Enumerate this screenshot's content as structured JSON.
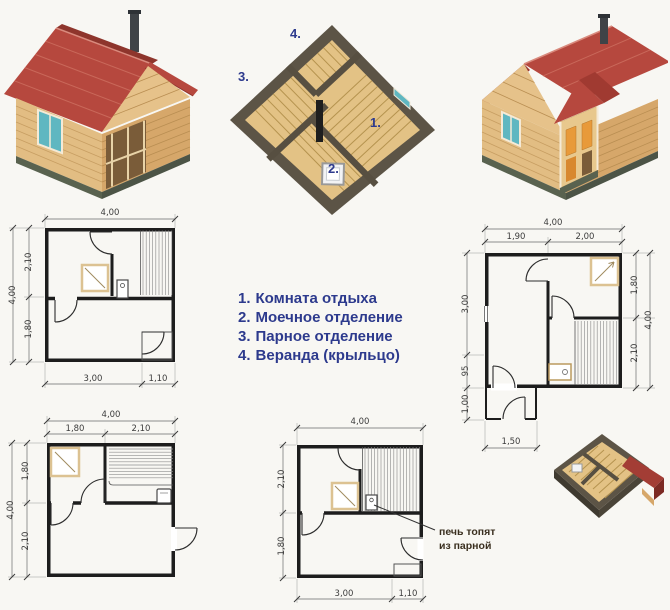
{
  "legend": {
    "items": [
      {
        "num": "1.",
        "label": "Комната отдыха"
      },
      {
        "num": "2.",
        "label": "Моечное отделение"
      },
      {
        "num": "3.",
        "label": "Парное отделение"
      },
      {
        "num": "4.",
        "label": "Веранда (крыльцо)"
      }
    ]
  },
  "cutaway": {
    "label_rest": "1.",
    "label_wash": "2.",
    "label_steam": "3.",
    "label_veranda": "4."
  },
  "annotation": {
    "line1": "печь топят",
    "line2": "из парной"
  },
  "plans": {
    "a": {
      "top": "4,00",
      "left_outer": "4,00",
      "left_top": "2,10",
      "left_bottom": "1,80",
      "bottom_main": "3,00",
      "bottom_porch": "1,10"
    },
    "b": {
      "top": "4,00",
      "top_left": "1,90",
      "top_right": "2,00",
      "left_top": "3,00",
      "left_mid": "95",
      "left_bottom": "1,00",
      "right_top": "1,80",
      "right_bottom": "2,10",
      "right_outer": "4,00",
      "bottom": "1,50"
    },
    "c": {
      "top": "4,00",
      "top_left": "1,80",
      "top_right": "2,10",
      "left_top": "1,80",
      "left_bottom": "2,10",
      "left_outer": "4,00"
    },
    "d": {
      "top": "4,00",
      "left_top": "2,10",
      "left_bottom": "1,80",
      "bottom_main": "3,00",
      "bottom_porch": "1,10"
    }
  },
  "colors": {
    "legend_text": "#2d3a8d",
    "roof_red": "#b6483e",
    "wood_light": "#e2bd83",
    "wood_dark": "#d6a76a",
    "window_teal": "#5fb7c1",
    "cutaway_wall": "#5c5446",
    "cutaway_floor": "#e3c285",
    "dim_text": "#3c3c3c",
    "annotation_text": "#3a2f1f"
  }
}
